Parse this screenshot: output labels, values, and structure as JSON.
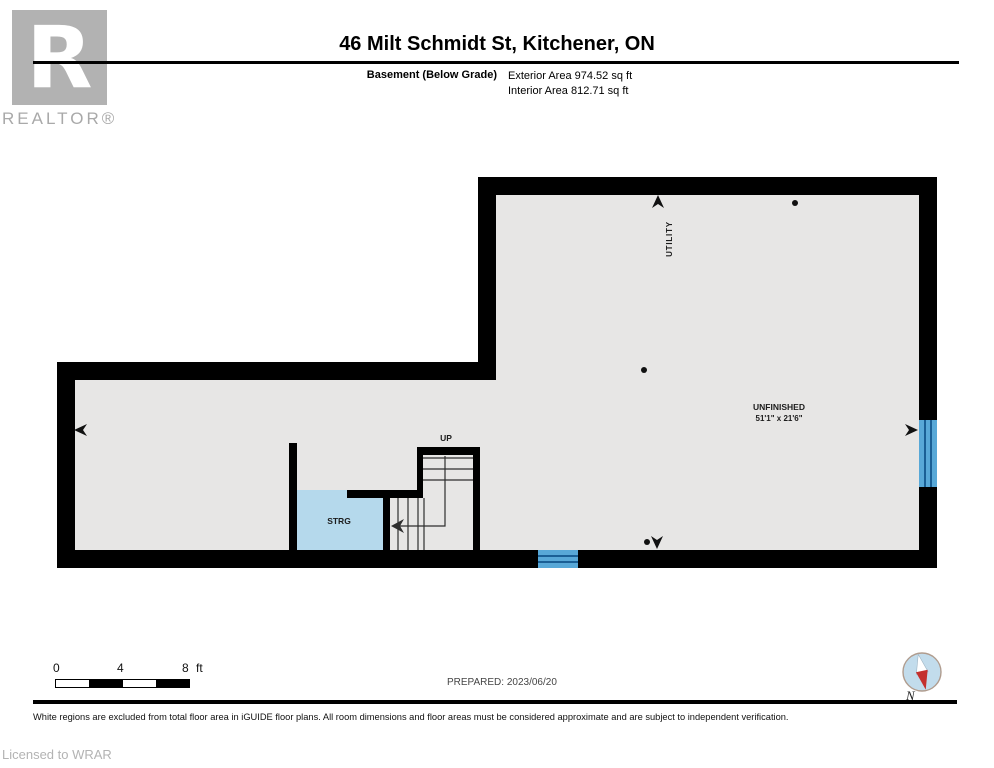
{
  "header": {
    "logo_letter": "R",
    "logo_caption": "REALTOR®",
    "title": "46 Milt Schmidt St, Kitchener, ON",
    "floor_label": "Basement (Below Grade)",
    "exterior_area": "Exterior Area 974.52 sq ft",
    "interior_area": "Interior Area 812.71 sq ft"
  },
  "plan": {
    "labels": {
      "utility": "UTILITY",
      "unfinished": "UNFINISHED",
      "unfinished_dims": "51'1\" x 21'6\"",
      "storage": "STRG",
      "up": "UP"
    }
  },
  "footer": {
    "scale": {
      "labels": [
        "0",
        "4",
        "8"
      ],
      "unit": "ft"
    },
    "prepared": "PREPARED: 2023/06/20",
    "compass": "N",
    "disclaimer": "White regions are excluded from total floor area in iGUIDE floor plans. All room dimensions and floor areas must be considered approximate and are subject to independent verification.",
    "licensed": "Licensed to WRAR"
  },
  "colors": {
    "wall": "#000000",
    "interior": "#e7e6e5",
    "storage_fill": "#b5d9ec",
    "window_fill": "#58a8d7",
    "window_line": "#1a5f95",
    "compass_fill": "#c2dcec",
    "compass_red": "#c4302e"
  }
}
